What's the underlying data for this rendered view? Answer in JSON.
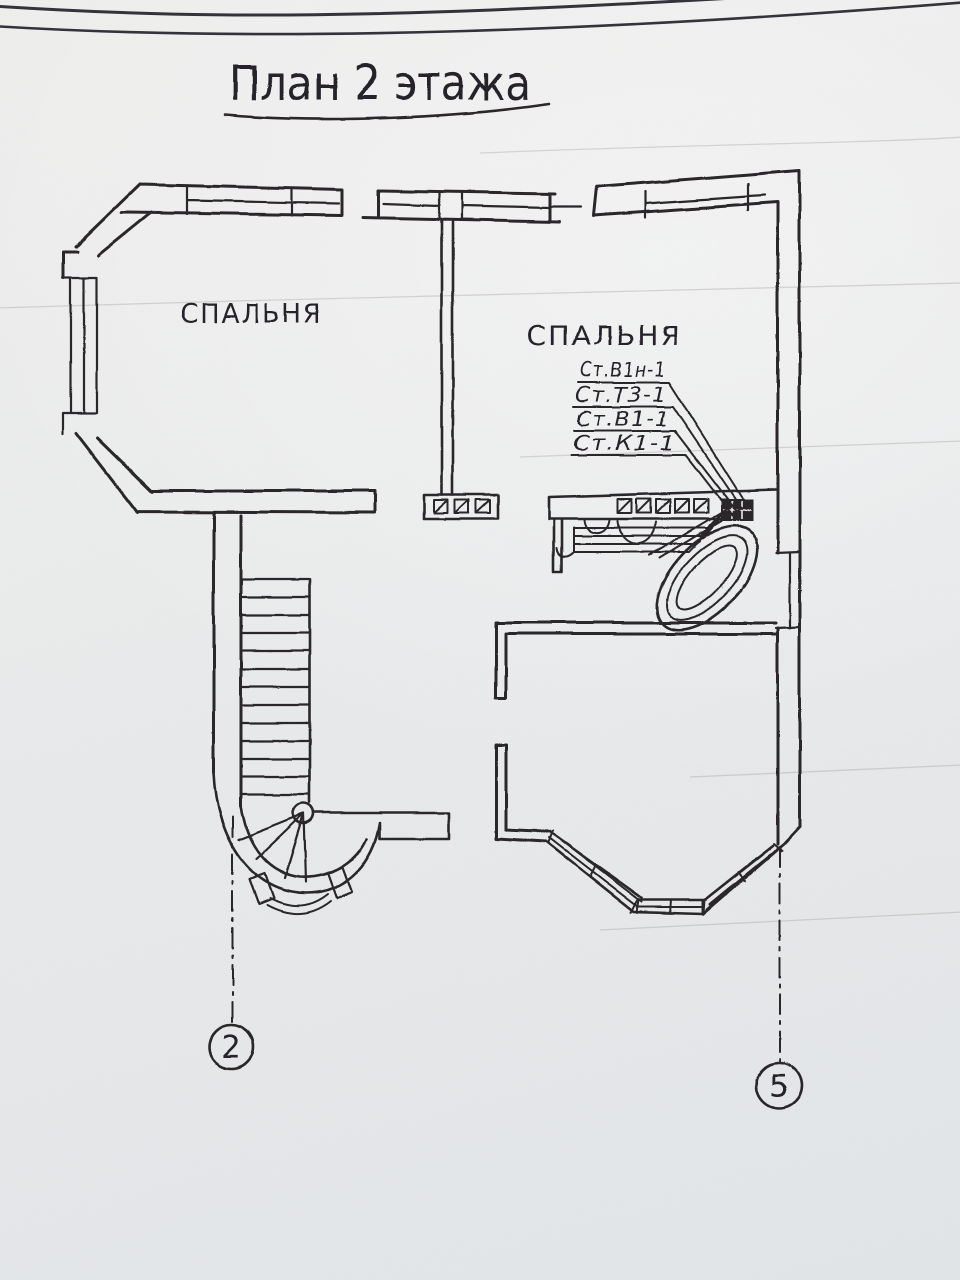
{
  "title": "План 2 этажа",
  "rooms": [
    "СПАЛЬНЯ",
    "СПАЛЬНЯ"
  ],
  "risers": [
    "Ст.В1н-1",
    "Ст.Т3-1",
    "Ст.В1-1",
    "Ст.К1-1"
  ],
  "axis_markers": [
    "2",
    "5"
  ],
  "colors": {
    "ink": "#2a282c",
    "paper": "#e9e9e8"
  }
}
